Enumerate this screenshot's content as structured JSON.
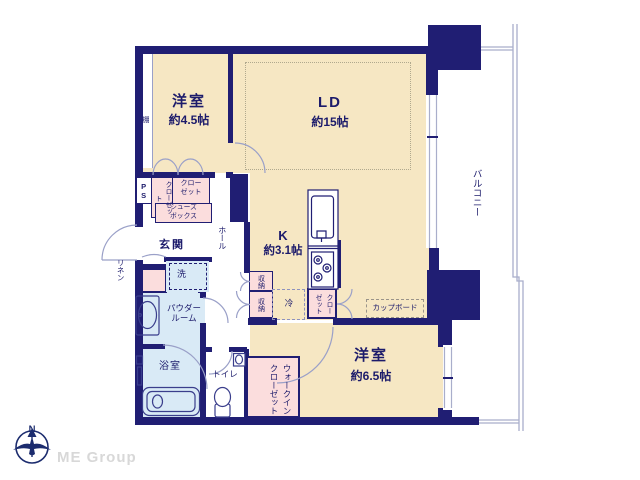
{
  "palette": {
    "wall_navy": "#201e73",
    "floor_cream": "#f6e7c3",
    "closet_pink": "#fbdddd",
    "wet_blue": "#d9eaf6",
    "thin_line": "#a9aecb",
    "text_navy": "#1c1b6b",
    "brand_gray": "#d8d8d8"
  },
  "rooms": {
    "western1": {
      "label": "洋室",
      "size": "約4.5帖"
    },
    "living": {
      "label": "LD",
      "size": "約15帖"
    },
    "kitchen": {
      "label": "K",
      "size": "約3.1帖"
    },
    "western2": {
      "label": "洋室",
      "size": "約6.5帖"
    },
    "balcony": {
      "label": "バルコニー"
    },
    "entrance": {
      "label": "玄関"
    },
    "hall": {
      "label": "ホール"
    },
    "powder_room": {
      "label": "パウダールーム"
    },
    "bath": {
      "label": "浴室"
    },
    "toilet": {
      "label": "トイレ"
    },
    "walk_in_closet": {
      "label": "ウォークインクローゼット"
    }
  },
  "storage": {
    "shelf": "棚",
    "pipe_space": "PS",
    "closet_entry_vertical": "クローゼット",
    "closet_entry": "クローゼット",
    "shoe_box": "シューズボックス",
    "linen": "リネン",
    "washer": "洗",
    "storage_a": "収納",
    "storage_b": "収納",
    "fridge": "冷",
    "closet_kitchen": "クローゼット",
    "cupboard": "カップボード"
  },
  "footer": {
    "compass_label": "N",
    "brand": "ME Group"
  }
}
